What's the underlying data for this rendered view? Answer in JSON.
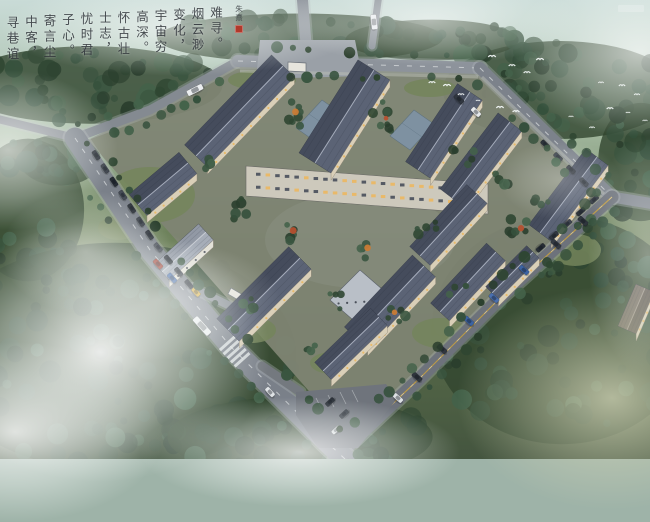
{
  "scene": {
    "type": "aerial architectural rendering at dusk",
    "subject": "courtyard-style campus with dark slate gable roofs surrounded by misty forest and perimeter roads"
  },
  "calligraphy": {
    "reading": "vertical columns, right to left",
    "columns": [
      "难寻。",
      "烟云渺",
      "变化，",
      "宇宙穷",
      "高深。",
      "怀古壮",
      "士志，",
      "忧时君",
      "子心。",
      "寄言尘",
      "中客，",
      "寻巷谊"
    ],
    "signature": "朱熹",
    "ink_color": "#2a2f35",
    "seal_color": "#b0392b"
  },
  "palette": {
    "mist": "#e8f1ee",
    "forest_dark": "#2f4632",
    "forest_mid": "#3a5540",
    "lawn": "#74855c",
    "site_ground": "#7e8473",
    "road": "#7a8089",
    "road_light": "#9aa0a7",
    "road_dark": "#6d727b",
    "roof_nw": "#454c5c",
    "roof_se": "#5b6375",
    "ridge": "#aab1c0",
    "facade": "#d9cfb8",
    "window_amber": "#eab864",
    "yellow_line": "#c8a13f",
    "white_line": "#dfe2e4",
    "bird": "#f6fafa"
  },
  "site": {
    "outline": [
      [
        88,
        140
      ],
      [
        240,
        62
      ],
      [
        480,
        70
      ],
      [
        608,
        196
      ],
      [
        352,
        440
      ]
    ],
    "ground": "#7e8473"
  },
  "roads": [
    {
      "name": "nw-approach",
      "pts": [
        [
          -6,
          118
        ],
        [
          75,
          138
        ]
      ],
      "w": 8,
      "c": "#81868d",
      "trees": false
    },
    {
      "name": "nw-edge",
      "pts": [
        [
          75,
          138
        ],
        [
          150,
          110
        ],
        [
          238,
          61
        ]
      ],
      "w": 9,
      "c": "#848a91",
      "trees": true
    },
    {
      "name": "north",
      "pts": [
        [
          238,
          61
        ],
        [
          480,
          68
        ]
      ],
      "w": 12,
      "c": "#8d939b",
      "trees": true,
      "mark": "wdash"
    },
    {
      "name": "north-stub",
      "pts": [
        [
          306,
          44
        ],
        [
          302,
          -6
        ]
      ],
      "w": 11,
      "c": "#8d939b",
      "trees": false
    },
    {
      "name": "north-stub2",
      "pts": [
        [
          372,
          46
        ],
        [
          379,
          -6
        ]
      ],
      "w": 7,
      "c": "#878d95",
      "trees": false
    },
    {
      "name": "northeast",
      "pts": [
        [
          480,
          68
        ],
        [
          612,
          197
        ]
      ],
      "w": 12,
      "c": "#7c828b",
      "trees": true,
      "mark": "wdash"
    },
    {
      "name": "east-spur",
      "pts": [
        [
          612,
          197
        ],
        [
          654,
          204
        ]
      ],
      "w": 11,
      "c": "#7c828b",
      "trees": false
    },
    {
      "name": "southeast",
      "pts": [
        [
          612,
          197
        ],
        [
          500,
          298
        ],
        [
          420,
          378
        ],
        [
          352,
          442
        ],
        [
          335,
          459
        ]
      ],
      "w": 13,
      "c": "#6d727b",
      "trees": true,
      "mark": "yellow"
    },
    {
      "name": "west",
      "pts": [
        [
          75,
          138
        ],
        [
          150,
          250
        ],
        [
          232,
          348
        ],
        [
          330,
          445
        ],
        [
          345,
          459
        ]
      ],
      "w": 21,
      "c": "#7a8089",
      "trees": true,
      "mark": "wdash"
    },
    {
      "name": "gate-stub",
      "pts": [
        [
          193,
          288
        ],
        [
          230,
          306
        ]
      ],
      "w": 8,
      "c": "#848a91",
      "trees": false
    },
    {
      "name": "lot-entry",
      "pts": [
        [
          262,
          366
        ],
        [
          300,
          392
        ]
      ],
      "w": 9,
      "c": "#74797f",
      "trees": false
    }
  ],
  "plaza": [
    [
      260,
      40
    ],
    [
      355,
      40
    ],
    [
      362,
      76
    ],
    [
      256,
      79
    ]
  ],
  "parking_lot": {
    "poly": [
      [
        296,
        392
      ],
      [
        386,
        384
      ],
      [
        396,
        400
      ],
      [
        358,
        448
      ],
      [
        318,
        448
      ],
      [
        296,
        415
      ]
    ],
    "ticks": [
      [
        316,
        398,
        322,
        410
      ],
      [
        328,
        395,
        334,
        407
      ],
      [
        340,
        392,
        346,
        404
      ],
      [
        352,
        390,
        358,
        402
      ]
    ]
  },
  "sidewalks": [
    [
      [
        240,
        71
      ],
      [
        478,
        77
      ]
    ],
    [
      [
        482,
        77
      ],
      [
        604,
        194
      ]
    ]
  ],
  "crosswalk": {
    "x": 235,
    "y": 352,
    "angle": 48
  },
  "gatehouses": [
    [
      [
        288,
        62
      ],
      [
        306,
        63
      ],
      [
        306,
        72
      ],
      [
        288,
        71
      ]
    ],
    [
      [
        231,
        288
      ],
      [
        243,
        295
      ],
      [
        240,
        301
      ],
      [
        228,
        294
      ]
    ]
  ],
  "slab": {
    "pts": [
      [
        246,
        166
      ],
      [
        488,
        184
      ],
      [
        488,
        214
      ],
      [
        246,
        196
      ]
    ],
    "fill": "#cdc9bc",
    "slope": 0.0744
  },
  "glass_links": [
    [
      [
        296,
        128
      ],
      [
        322,
        100
      ],
      [
        342,
        114
      ],
      [
        316,
        142
      ]
    ],
    [
      [
        390,
        136
      ],
      [
        414,
        110
      ],
      [
        434,
        124
      ],
      [
        410,
        150
      ]
    ],
    [
      [
        468,
        152
      ],
      [
        490,
        130
      ],
      [
        508,
        144
      ],
      [
        486,
        166
      ]
    ]
  ],
  "white_blocks": [
    [
      [
        330,
        300
      ],
      [
        360,
        270
      ],
      [
        390,
        296
      ],
      [
        360,
        326
      ]
    ]
  ],
  "roofs": [
    [
      196,
      156,
      283,
      66,
      16,
      "dark"
    ],
    [
      315,
      163,
      374,
      70,
      19,
      "dark"
    ],
    [
      418,
      170,
      470,
      92,
      15,
      "dark"
    ],
    [
      452,
      198,
      510,
      122,
      15,
      "dark"
    ],
    [
      540,
      233,
      597,
      157,
      14,
      "dark"
    ],
    [
      420,
      256,
      477,
      194,
      14,
      "dark"
    ],
    [
      138,
      205,
      188,
      163,
      14,
      "dark"
    ],
    [
      162,
      272,
      206,
      232,
      11,
      "light"
    ],
    [
      228,
      330,
      300,
      258,
      16,
      "dark"
    ],
    [
      356,
      338,
      424,
      266,
      16,
      "dark"
    ],
    [
      323,
      371,
      379,
      317,
      12,
      "dark"
    ],
    [
      440,
      312,
      496,
      252,
      13,
      "dark"
    ],
    [
      492,
      293,
      533,
      252,
      9,
      "dark"
    ],
    [
      627,
      330,
      645,
      288,
      10,
      "brown"
    ]
  ],
  "lawns": [
    [
      150,
      195,
      45,
      28
    ],
    [
      262,
      80,
      34,
      10
    ],
    [
      430,
      88,
      26,
      9
    ],
    [
      575,
      250,
      26,
      16
    ],
    [
      252,
      330,
      24,
      13
    ],
    [
      440,
      333,
      28,
      15
    ],
    [
      332,
      363,
      22,
      11
    ],
    [
      118,
      228,
      20,
      12
    ]
  ],
  "courtyard_trees": [
    [
      297,
      112,
      16,
      7,
      1
    ],
    [
      385,
      118,
      18,
      8,
      1
    ],
    [
      463,
      155,
      12,
      5,
      0
    ],
    [
      520,
      228,
      13,
      6,
      1
    ],
    [
      556,
      268,
      11,
      5,
      0
    ],
    [
      236,
      206,
      13,
      6,
      0
    ],
    [
      294,
      233,
      12,
      5,
      1
    ],
    [
      252,
      305,
      12,
      5,
      0
    ],
    [
      336,
      300,
      10,
      4,
      0
    ],
    [
      396,
      310,
      12,
      5,
      1
    ],
    [
      428,
      230,
      11,
      5,
      0
    ],
    [
      458,
      290,
      10,
      4,
      0
    ],
    [
      205,
      165,
      10,
      4,
      0
    ],
    [
      540,
      206,
      9,
      4,
      0
    ],
    [
      310,
      344,
      9,
      4,
      0
    ],
    [
      368,
      250,
      9,
      4,
      1
    ],
    [
      585,
      225,
      9,
      4,
      0
    ],
    [
      500,
      180,
      10,
      4,
      0
    ]
  ],
  "forest_clusters": [
    [
      90,
      85,
      130,
      38,
      55
    ],
    [
      300,
      38,
      140,
      24,
      30
    ],
    [
      560,
      90,
      115,
      48,
      50
    ],
    [
      28,
      210,
      55,
      70,
      30
    ],
    [
      115,
      357,
      178,
      112,
      100
    ],
    [
      300,
      437,
      130,
      40,
      40
    ],
    [
      562,
      330,
      128,
      112,
      80
    ],
    [
      641,
      162,
      42,
      58,
      22
    ],
    [
      432,
      40,
      85,
      20,
      18
    ],
    [
      60,
      160,
      40,
      25,
      15
    ]
  ],
  "cars": [
    [
      158,
      264,
      48,
      "#9c3a2e",
      11,
      5
    ],
    [
      172,
      278,
      48,
      "#3c63a2",
      11,
      5
    ],
    [
      196,
      292,
      48,
      "#d6ab3d",
      10,
      4.8
    ],
    [
      202,
      326,
      48,
      "#eaedef",
      22,
      6.5
    ],
    [
      270,
      392,
      48,
      "#dfe3e6",
      11,
      5
    ],
    [
      195,
      90,
      -27,
      "#eceef0",
      17,
      6
    ],
    [
      374,
      22,
      83,
      "#e9ecef",
      15,
      6
    ],
    [
      459,
      99,
      44,
      "#30363f",
      11,
      5
    ],
    [
      476,
      112,
      44,
      "#e6e9ec",
      11,
      5
    ],
    [
      583,
      221,
      42,
      "#2f353d",
      11,
      5
    ],
    [
      556,
      244,
      42,
      "#343a43",
      11,
      5
    ],
    [
      524,
      270,
      42,
      "#3c63a2",
      11,
      5
    ],
    [
      494,
      298,
      42,
      "#4a6fae",
      11,
      5
    ],
    [
      469,
      321,
      42,
      "#3c63a2",
      11,
      5
    ],
    [
      442,
      349,
      42,
      "#30363f",
      11,
      5
    ],
    [
      417,
      377,
      42,
      "#2f353d",
      11,
      5
    ],
    [
      398,
      398,
      42,
      "#dde1e4",
      11,
      5
    ],
    [
      330,
      402,
      -42,
      "#2b3139",
      10,
      4.6
    ],
    [
      344,
      414,
      -42,
      "#343a43",
      10,
      4.6
    ],
    [
      336,
      430,
      -42,
      "#d8dcdf",
      10,
      4.6
    ]
  ],
  "parked_rows": [
    {
      "road": 8,
      "dists": [
        26,
        42,
        58,
        74,
        90,
        106,
        122,
        138,
        154,
        170,
        186
      ],
      "off": 8,
      "colors": [
        "#2c323a",
        "#3a4049",
        "#262c34",
        "#454b55"
      ]
    },
    {
      "road": 5,
      "dists": [
        100,
        118,
        136,
        154
      ],
      "off": -9,
      "colors": [
        "#2c323a",
        "#3a4049"
      ]
    },
    {
      "road": 7,
      "dists": [
        15,
        33,
        51,
        69,
        87
      ],
      "off": -10,
      "colors": [
        "#30363f",
        "#262c34",
        "#3f454f"
      ]
    }
  ],
  "birds": [
    [
      492,
      57
    ],
    [
      512,
      66
    ],
    [
      527,
      73
    ],
    [
      540,
      60
    ],
    [
      432,
      83
    ],
    [
      447,
      86
    ],
    [
      461,
      95
    ],
    [
      478,
      101
    ],
    [
      500,
      108
    ],
    [
      516,
      112
    ],
    [
      601,
      83
    ],
    [
      622,
      86
    ],
    [
      637,
      95
    ],
    [
      610,
      109
    ],
    [
      628,
      113
    ],
    [
      645,
      121
    ],
    [
      592,
      128
    ],
    [
      571,
      117
    ]
  ],
  "mist_blobs": [
    [
      100,
      352,
      170,
      130,
      "w",
      0.95
    ],
    [
      15,
      432,
      150,
      90,
      "w",
      0.85
    ],
    [
      300,
      452,
      160,
      55,
      "w",
      0.8
    ],
    [
      8,
      150,
      110,
      80,
      "w",
      0.7
    ],
    [
      180,
      28,
      180,
      48,
      "w",
      0.6
    ],
    [
      430,
      20,
      150,
      45,
      "w",
      0.6
    ],
    [
      640,
      52,
      130,
      85,
      "w",
      0.7
    ],
    [
      612,
      398,
      155,
      112,
      "o",
      0.85
    ],
    [
      648,
      255,
      60,
      120,
      "w",
      0.45
    ],
    [
      86,
      252,
      85,
      62,
      "w",
      0.5
    ],
    [
      160,
      300,
      120,
      60,
      "w",
      0.45
    ],
    [
      560,
      180,
      60,
      40,
      "w",
      0.3
    ]
  ]
}
